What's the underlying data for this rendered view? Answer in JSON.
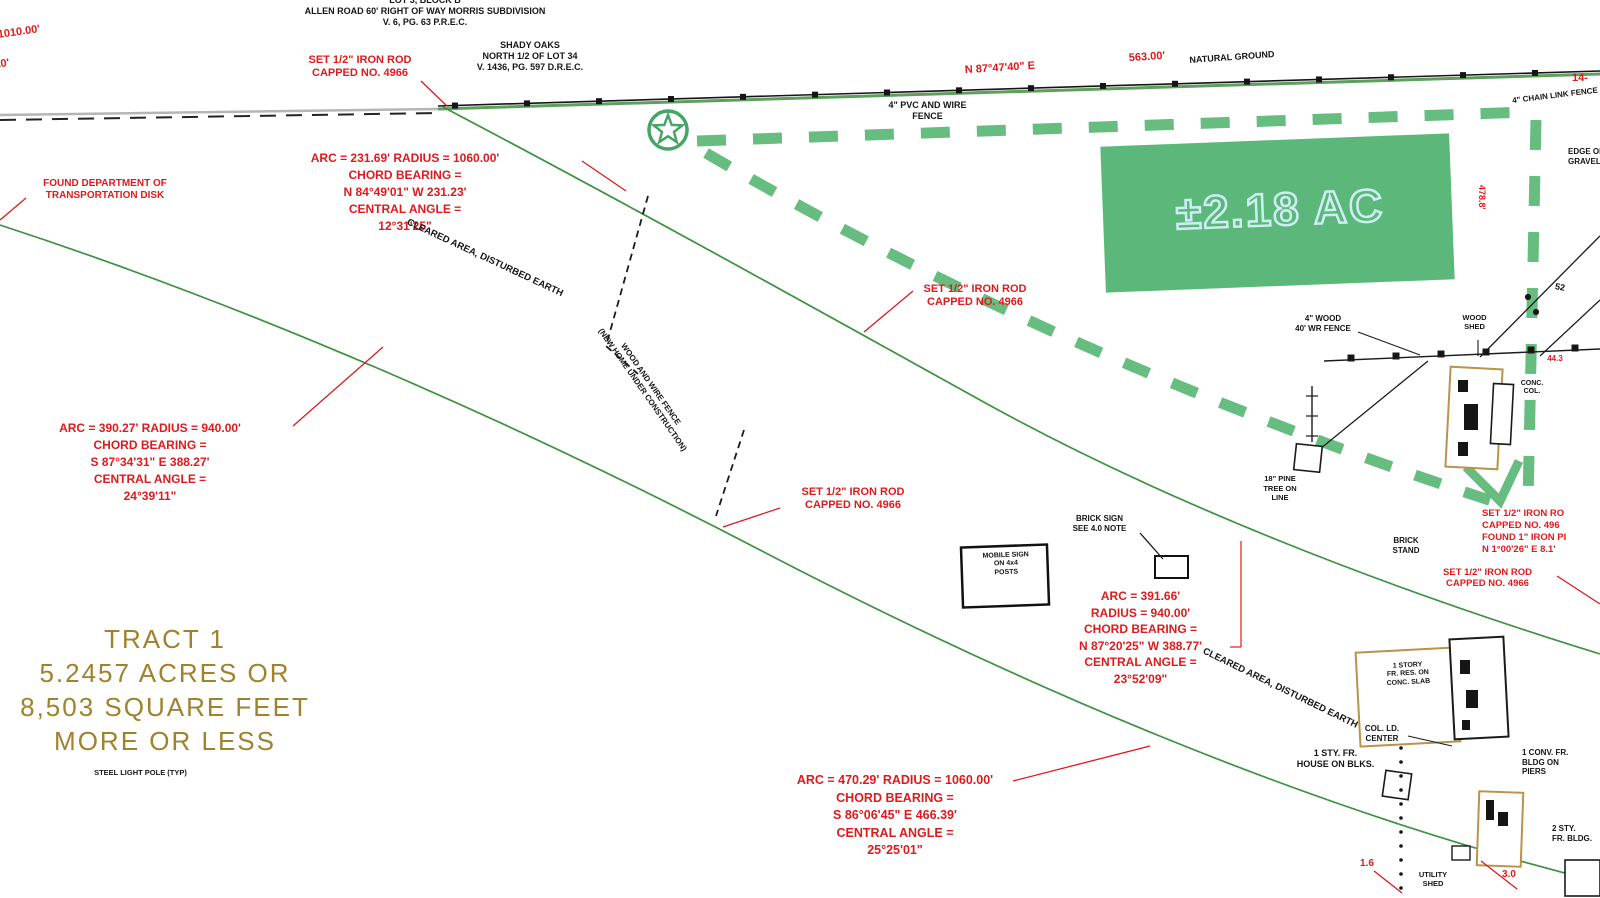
{
  "drawing": {
    "type": "land-survey-plat",
    "colors": {
      "annotation_red": "#dd1b1b",
      "boundary_green_dash": "#66bd7f",
      "area_fill_green": "#5cb87a",
      "road_edge_green": "#3d9140",
      "tract_olive": "#a0812c",
      "building_tan": "#b8934a",
      "linework_black": "#151515"
    }
  },
  "area_highlight": {
    "text": "±2.18 AC"
  },
  "tract": {
    "lines": [
      "TRACT 1",
      "5.2457 ACRES OR",
      "8,503 SQUARE FEET",
      "MORE OR LESS"
    ],
    "note": "STEEL LIGHT POLE (TYP)"
  },
  "labels": {
    "subdivA": [
      "LOT 3, BLOCK B",
      "ALLEN ROAD 60' RIGHT OF WAY MORRIS SUBDIVISION",
      "V. 6, PG. 63 P.R.E.C."
    ],
    "subdivB": [
      "SHADY OAKS",
      "NORTH 1/2 OF LOT 34",
      "V. 1436, PG. 597 D.R.E.C."
    ],
    "bearing_top": "N 87°47'40\" E",
    "dist_top": "563.00'",
    "natural_ground": "NATURAL GROUND",
    "pvc_fence": [
      "4\" PVC AND WIRE",
      "FENCE"
    ],
    "frag1": "1010.00'",
    "frag2": "10'",
    "n14": "14-",
    "rod_top": [
      "SET 1/2\" IRON ROD",
      "CAPPED NO. 4966"
    ],
    "rod_mid": [
      "SET 1/2\" IRON ROD",
      "CAPPED NO. 4966"
    ],
    "rod_low": [
      "SET 1/2\" IRON ROD",
      "CAPPED NO. 4966"
    ],
    "found_disk": [
      "FOUND DEPARTMENT OF",
      "TRANSPORTATION DISK"
    ],
    "curve_nw": [
      "ARC = 231.69' RADIUS = 1060.00'",
      "CHORD BEARING =",
      "N 84°49'01\" W 231.23'",
      "CENTRAL ANGLE =",
      "12°31'25\""
    ],
    "curve_w": [
      "ARC = 390.27' RADIUS = 940.00'",
      "CHORD BEARING =",
      "S 87°34'31\" E 388.27'",
      "CENTRAL ANGLE =",
      "24°39'11\""
    ],
    "curve_c": [
      "ARC = 391.66'",
      "RADIUS = 940.00'",
      "CHORD BEARING =",
      "N 87°20'25\" W 388.77'",
      "CENTRAL ANGLE =",
      "23°52'09\""
    ],
    "curve_s": [
      "ARC = 470.29' RADIUS = 1060.00'",
      "CHORD BEARING =",
      "S 86°06'45\" E 466.39'",
      "CENTRAL ANGLE =",
      "25°25'01\""
    ],
    "cleared1": "CLEARED AREA, DISTURBED EARTH",
    "cleared2": "CLEARED AREA, DISTURBED EARTH",
    "fence_rot": [
      "WOOD AND WIRE FENCE",
      "(NEW HOME UNDER CONSTRUCTION)"
    ],
    "sign_box": [
      "MOBILE SIGN",
      "ON 4x4",
      "POSTS"
    ],
    "brick_sign": [
      "BRICK SIGN",
      "SEE 4.0 NOTE"
    ],
    "wood_fence_r": [
      "4\" WOOD",
      "40' WR FENCE"
    ],
    "wood_shed": [
      "WOOD",
      "SHED"
    ],
    "conc_col": [
      "CONC.",
      "COL."
    ],
    "pole52": "52",
    "pine": [
      "18\" PINE",
      "TREE ON",
      "LINE"
    ],
    "brick_stand": [
      "BRICK",
      "STAND"
    ],
    "rod_edge": [
      "SET 1/2\" IRON RO",
      "CAPPED NO. 496",
      "FOUND 1\" IRON PI",
      "N 1°00'26\" E 8.1'"
    ],
    "rod_edge2": [
      "SET 1/2\" IRON ROD",
      "CAPPED NO. 4966"
    ],
    "chain_link": "4\" CHAIN LINK FENCE",
    "edge_gravel": [
      "EDGE OF",
      "GRAVEL"
    ],
    "v478": "478.8'",
    "n443": "44.3",
    "d16": "1.6",
    "d30": "3.0",
    "bldgA_text": [
      "1 STORY",
      "FR. RES. ON",
      "CONC. SLAB"
    ],
    "col_ld": [
      "COL. LD.",
      "CENTER"
    ],
    "house_blocks": [
      "1 STY. FR.",
      "HOUSE ON BLKS."
    ],
    "conv_fr": [
      "1 CONV. FR.",
      "BLDG ON",
      "PIERS"
    ],
    "two_sty": [
      "2 STY.",
      "FR. BLDG."
    ],
    "utility": [
      "UTILITY",
      "SHED"
    ]
  }
}
